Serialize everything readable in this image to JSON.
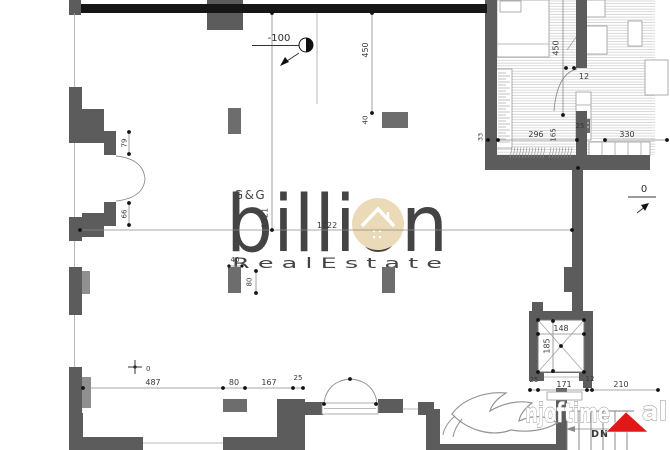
{
  "watermark": {
    "gg": "G&G",
    "brand": "billion",
    "tagline": "R e a l   E s t a t e",
    "portal_name": "njoftime",
    "portal_tld": "al"
  },
  "level_markers": {
    "mezzanine": "-100",
    "ground": "0",
    "datum": "0"
  },
  "stairs": {
    "direction_label": "DN"
  },
  "dimensions": {
    "main_height": "1521",
    "main_width": "1722",
    "upper_bay": "450",
    "upper_column": "40",
    "left_door_upper": "79",
    "left_door_lower": "66",
    "center_column_width": "40",
    "center_column_depth": "80",
    "bottom_left_run": [
      "487",
      "80",
      "167",
      "25"
    ],
    "bottom_right_run": [
      "25",
      "171",
      "12",
      "210"
    ],
    "elevator_width": "148",
    "elevator_depth": "185",
    "apartment_bay": "450",
    "apartment_run": [
      "296",
      "165",
      "25",
      "330"
    ],
    "apartment_door": "12",
    "apartment_wall": "33"
  },
  "colors": {
    "brand_tan": "#ead9b5",
    "portal_red": "#e21717",
    "dn_orange": "#d09a52"
  }
}
